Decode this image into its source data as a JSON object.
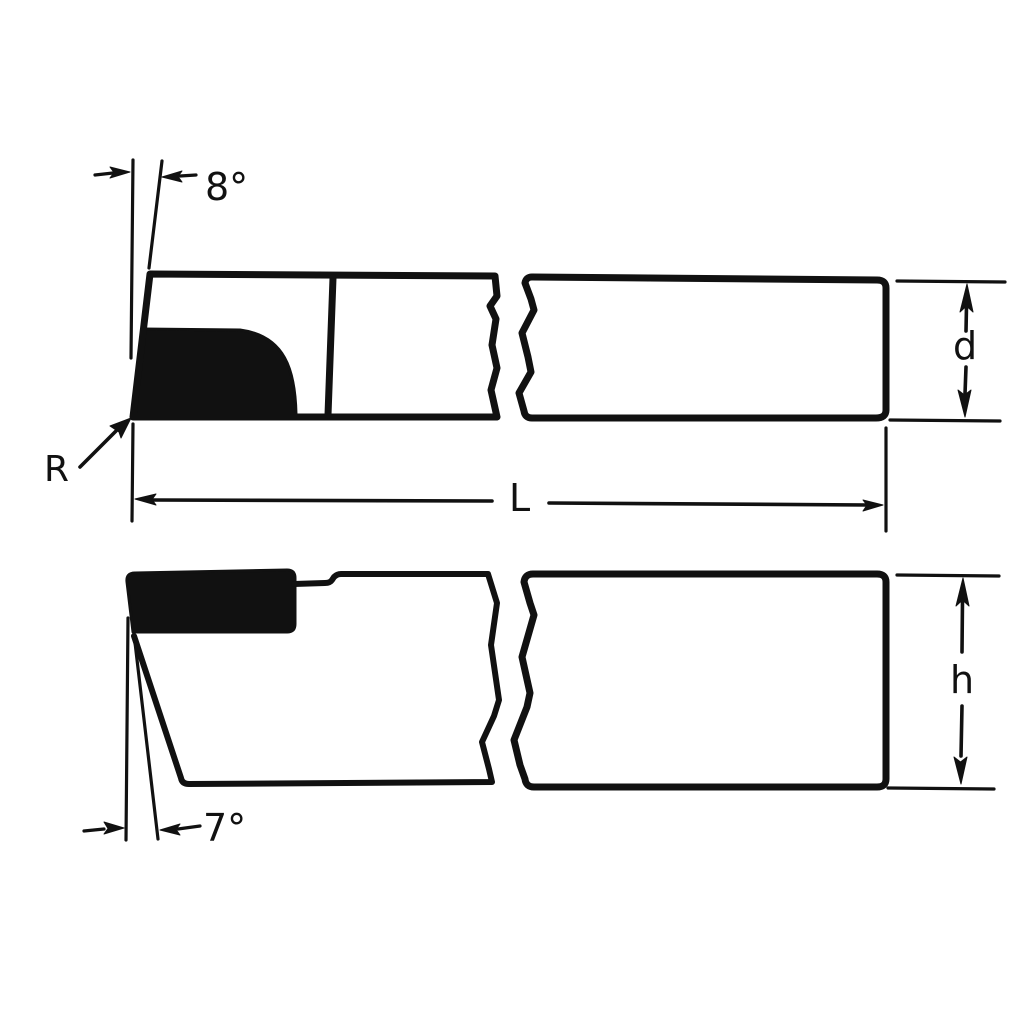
{
  "colors": {
    "ink": "#111111",
    "paper": "#ffffff"
  },
  "drawing": {
    "kind": "technical-drawing",
    "subject": "brazed-tip cutting tool, two views with break lines",
    "labels": {
      "top_view_angle": "8°",
      "nose_radius": "R",
      "length_dim": "L",
      "diameter_dim": "d",
      "side_view_angle": "7°",
      "height_dim": "h"
    }
  }
}
